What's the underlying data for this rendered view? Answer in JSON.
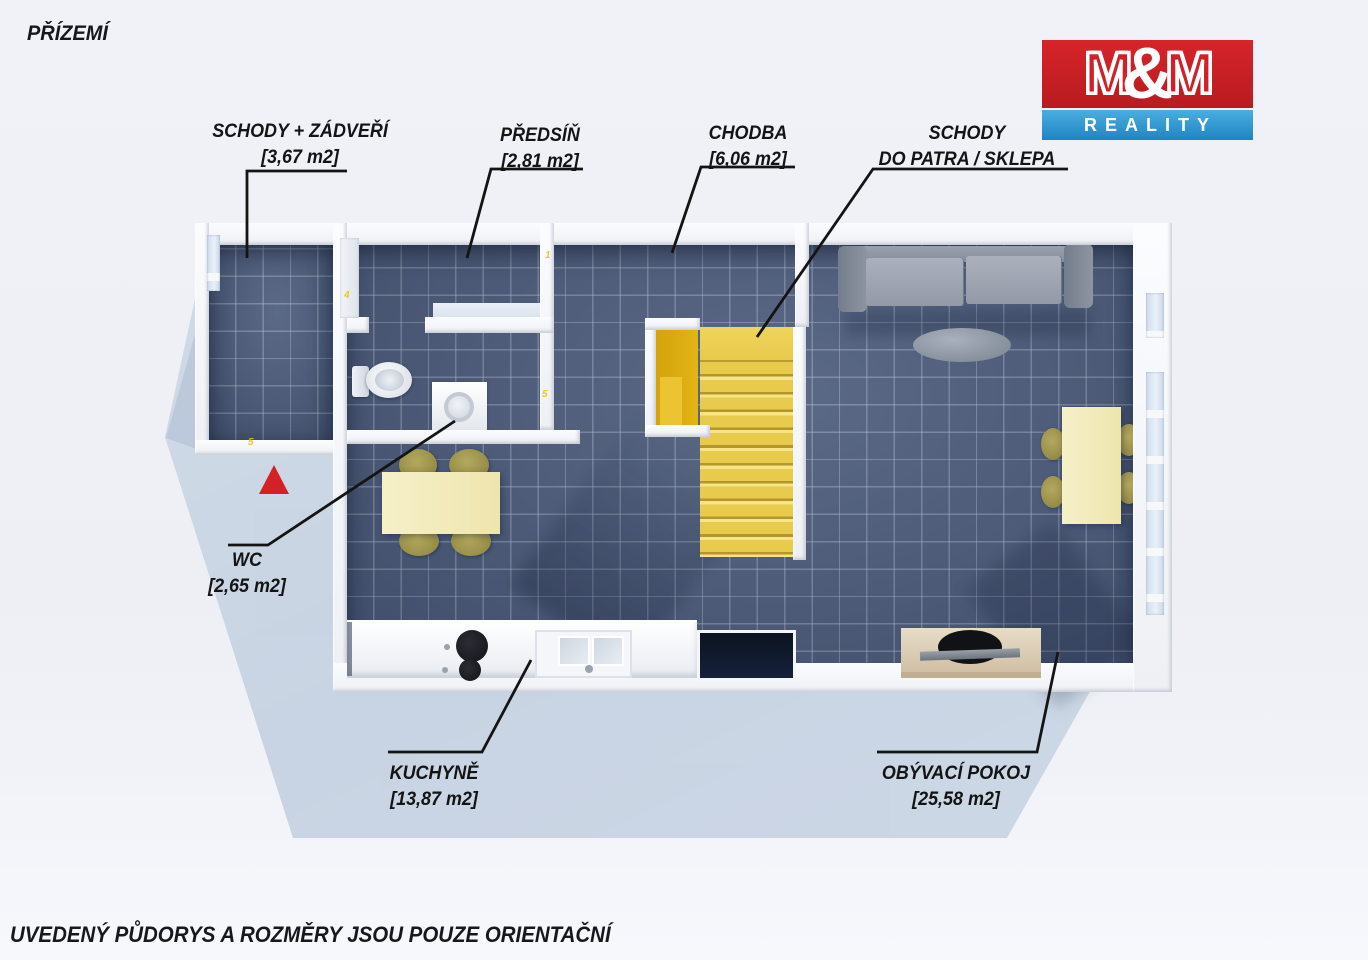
{
  "header": {
    "title": "PŘÍZEMÍ"
  },
  "logo": {
    "m1": "M",
    "amp": "&",
    "m2": "M",
    "line2": "REALITY"
  },
  "rooms": [
    {
      "line1": "SCHODY + ZÁDVEŘÍ",
      "line2": "[3,67 m2]"
    },
    {
      "line1": "PŘEDSÍŇ",
      "line2": "[2,81 m2]"
    },
    {
      "line1": "CHODBA",
      "line2": "[6,06 m2]"
    },
    {
      "line1": "SCHODY",
      "line2": "DO PATRA / SKLEPA"
    },
    {
      "line1": "WC",
      "line2": "[2,65 m2]"
    },
    {
      "line1": "KUCHYNĚ",
      "line2": "[13,87 m2]"
    },
    {
      "line1": "OBÝVACÍ POKOJ",
      "line2": "[25,58 m2]"
    }
  ],
  "marks": {
    "m1": "5",
    "m2": "4",
    "m3": "1",
    "m4": "5"
  },
  "footer": {
    "disclaimer": "UVEDENÝ PŮDORYS A ROZMĚRY JSOU POUZE ORIENTAČNÍ"
  },
  "colors": {
    "logo_red": "#cf2127",
    "logo_blue": "#2a94cf",
    "floor_blue": "#49597a",
    "stair_yellow": "#e7c94a",
    "wall_white": "#f7f8fa",
    "arrow_red": "#d42027",
    "furniture_cream": "#f2ecc0",
    "chair_olive": "#a59b4f",
    "label_text": "#141414"
  }
}
